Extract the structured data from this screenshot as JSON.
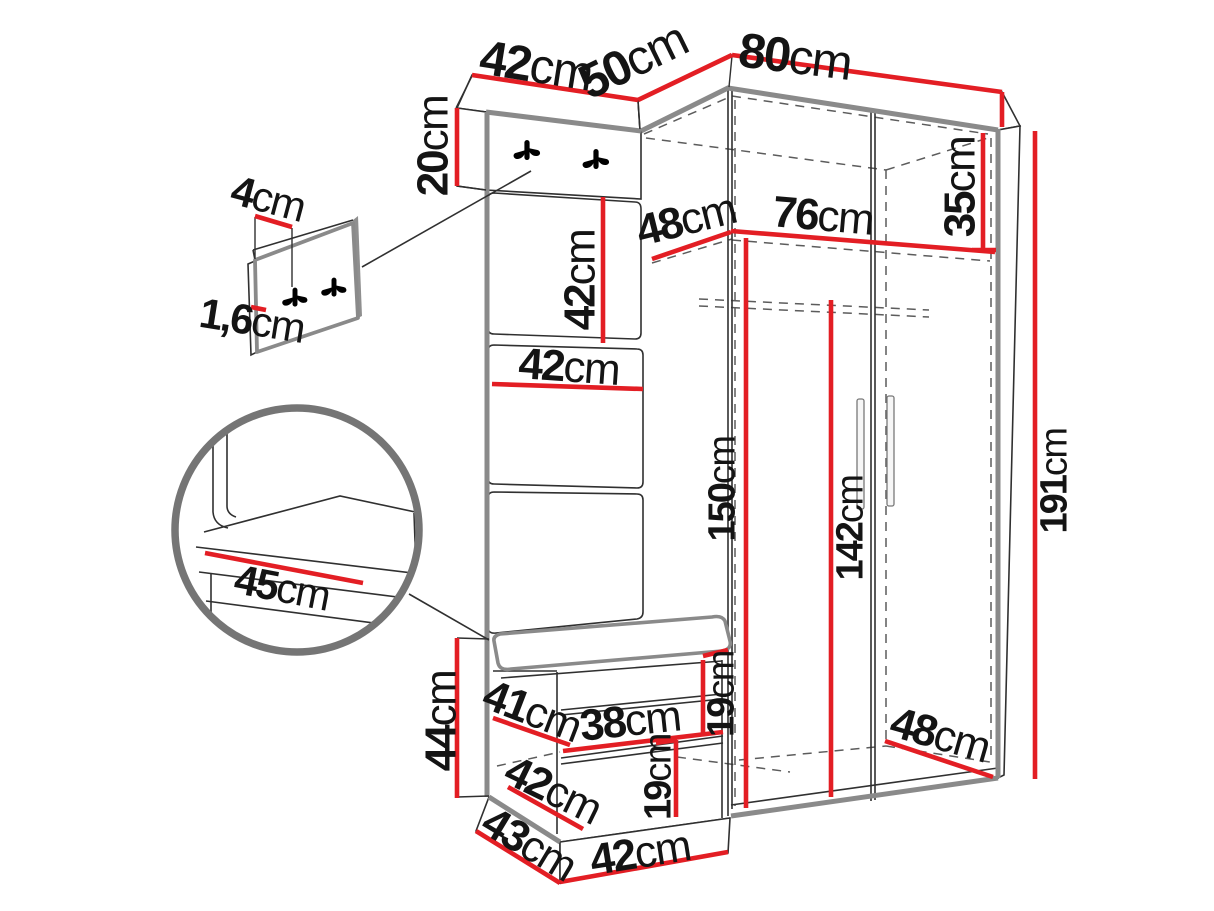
{
  "diagram": {
    "type": "furniture-dimension-diagram",
    "subject": "corner hallway wardrobe with hanger panel, bench and mini hook panel",
    "colors": {
      "dimension_red": "#e31e24",
      "outline_gray": "#8a8a8a",
      "line_dark": "#303030",
      "label_black": "#141414",
      "background": "#ffffff"
    },
    "dimensions": {
      "top_panel_width": {
        "value": "42",
        "unit": "cm"
      },
      "top_left_depth": {
        "value": "50",
        "unit": "cm"
      },
      "top_front_width": {
        "value": "80",
        "unit": "cm"
      },
      "hook_board_height": {
        "value": "20",
        "unit": "cm"
      },
      "mini_panel_hook_offset": {
        "value": "4",
        "unit": "cm"
      },
      "mini_panel_thickness": {
        "value": "1,6",
        "unit": "cm"
      },
      "top_compartment_height": {
        "value": "35",
        "unit": "cm"
      },
      "shelf_depth": {
        "value": "48",
        "unit": "cm"
      },
      "shelf_width": {
        "value": "76",
        "unit": "cm"
      },
      "panel_tile_height": {
        "value": "42",
        "unit": "cm"
      },
      "panel_tile_width": {
        "value": "42",
        "unit": "cm"
      },
      "interior_height": {
        "value": "150",
        "unit": "cm"
      },
      "rod_height": {
        "value": "142",
        "unit": "cm"
      },
      "total_height": {
        "value": "191",
        "unit": "cm"
      },
      "seat_depth": {
        "value": "45",
        "unit": "cm"
      },
      "bench_height": {
        "value": "44",
        "unit": "cm"
      },
      "bench_depth": {
        "value": "41",
        "unit": "cm"
      },
      "bench_shelf_width": {
        "value": "38",
        "unit": "cm"
      },
      "bench_upper_compartment": {
        "value": "19",
        "unit": "cm"
      },
      "bench_lower_width": {
        "value": "42",
        "unit": "cm"
      },
      "bench_lower_compartment": {
        "value": "19",
        "unit": "cm"
      },
      "base_depth": {
        "value": "43",
        "unit": "cm"
      },
      "base_width": {
        "value": "42",
        "unit": "cm"
      },
      "floor_depth": {
        "value": "48",
        "unit": "cm"
      }
    }
  }
}
